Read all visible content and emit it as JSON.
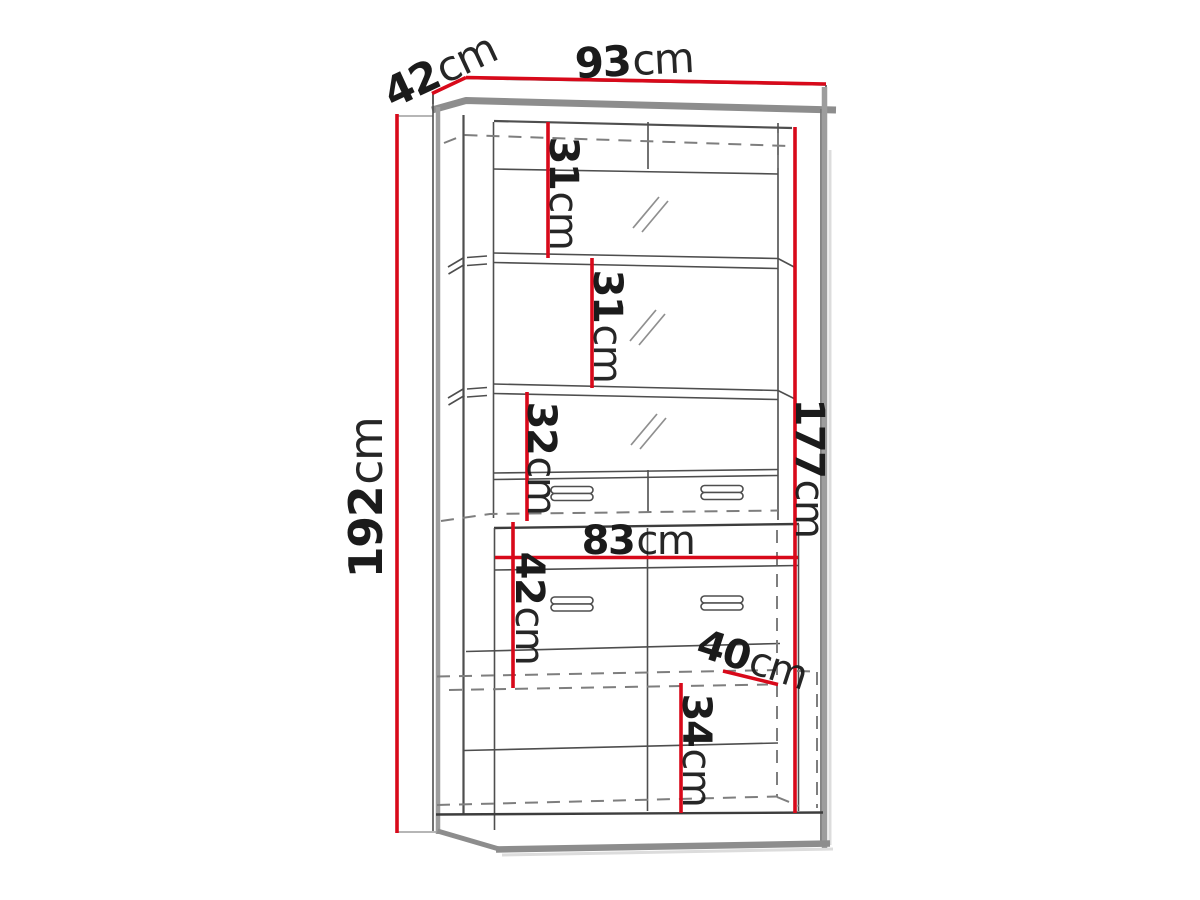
{
  "page": {
    "title": "Display cabinet dimension drawing",
    "unit": "cm"
  },
  "diagram": {
    "type": "furniture-dimension-line-drawing",
    "subject": "tall display cabinet with glass doors, drawers and bottom doors",
    "overall": {
      "width": "93",
      "depth": "42",
      "height": "192"
    }
  },
  "dims": {
    "top_depth": {
      "value": "42",
      "unit": "cm"
    },
    "top_width": {
      "value": "93",
      "unit": "cm"
    },
    "height": {
      "value": "192",
      "unit": "cm"
    },
    "shelf_1": {
      "value": "31",
      "unit": "cm"
    },
    "shelf_2": {
      "value": "31",
      "unit": "cm"
    },
    "shelf_3": {
      "value": "32",
      "unit": "cm"
    },
    "interior_height": {
      "value": "177",
      "unit": "cm"
    },
    "lower_width": {
      "value": "83",
      "unit": "cm"
    },
    "lower_height": {
      "value": "42",
      "unit": "cm"
    },
    "lower_depth": {
      "value": "40",
      "unit": "cm"
    },
    "door_height": {
      "value": "34",
      "unit": "cm"
    }
  },
  "colors": {
    "dimension": "#d8091a",
    "text": "#1b1b1b",
    "line": "#4e4e4e",
    "linedark": "#3d3d3d",
    "panel": "#9d9d9d",
    "molding": "#8d8d8d",
    "hidden": "#7e7e7e",
    "shadow": "#dcdcdc",
    "background": "#ffffff"
  }
}
